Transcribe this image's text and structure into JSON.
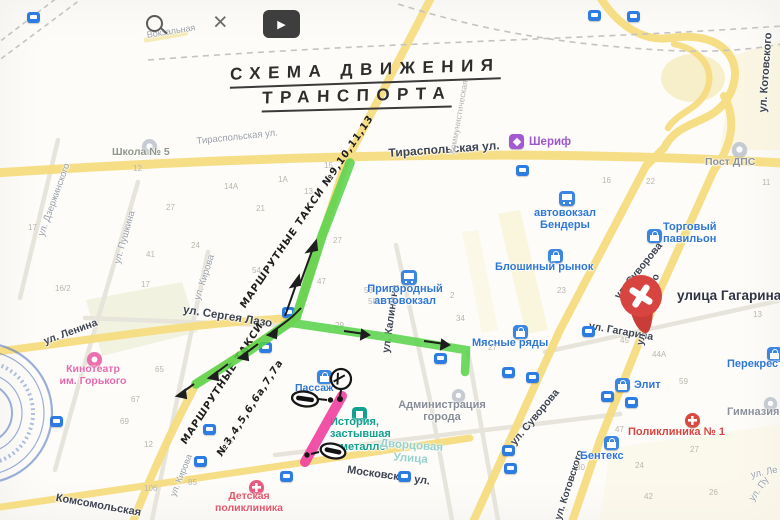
{
  "toolbar": {
    "close": "×",
    "play": "▶"
  },
  "title": {
    "line1": "СХЕМА ДВИЖЕНИЯ",
    "line2": "ТРАНСПОРТА"
  },
  "pin": {
    "label": "улица Гагарина"
  },
  "handwritten": [
    {
      "t": "МАРШРУТНЫЕ ТАКСИ №9,10,11,13",
      "x": 247,
      "y": 300,
      "r": -56,
      "s": 10
    },
    {
      "t": "МАРШРУТНЫЕ ТАКСИ",
      "x": 188,
      "y": 436,
      "r": -57,
      "s": 10
    },
    {
      "t": "№3,4,5,6,6а,7,7а",
      "x": 224,
      "y": 448,
      "r": -57,
      "s": 10
    }
  ],
  "colors": {
    "g": "#9aa0a8",
    "d": "#3e4450",
    "f": "#b8b5b0"
  },
  "streets": [
    {
      "t": "Вокзальная",
      "x": 146,
      "y": 30,
      "r": -9,
      "c": "g",
      "s": 9
    },
    {
      "t": "Тираспольская ул.",
      "x": 196,
      "y": 136,
      "r": -6,
      "c": "g",
      "s": 9.5
    },
    {
      "t": "Тираспольская ул.",
      "x": 388,
      "y": 146,
      "r": -4,
      "c": "d",
      "s": 12,
      "w": 700
    },
    {
      "t": "Коммунистическая",
      "x": 447,
      "y": 153,
      "r": -80,
      "c": "f",
      "s": 8.5
    },
    {
      "t": "ул. Дзержинского",
      "x": 36,
      "y": 234,
      "r": -70,
      "c": "g",
      "s": 9.5
    },
    {
      "t": "ул. Пушкина",
      "x": 112,
      "y": 262,
      "r": -74,
      "c": "g",
      "s": 9.5
    },
    {
      "t": "ул. Кирова",
      "x": 192,
      "y": 298,
      "r": -72,
      "c": "g",
      "s": 9.5
    },
    {
      "t": "ул. Кирова",
      "x": 168,
      "y": 494,
      "r": -68,
      "c": "g",
      "s": 9
    },
    {
      "t": "ул. Ленина",
      "x": 42,
      "y": 336,
      "r": -20,
      "c": "d",
      "s": 10.5,
      "w": 600
    },
    {
      "t": "ул. Сергея Лазо",
      "x": 184,
      "y": 304,
      "r": 9,
      "c": "d",
      "s": 11.5,
      "w": 600
    },
    {
      "t": "ул. Калинина",
      "x": 380,
      "y": 352,
      "r": -82,
      "c": "d",
      "s": 10.5,
      "w": 600
    },
    {
      "t": "Московская ул.",
      "x": 348,
      "y": 464,
      "r": 8,
      "c": "d",
      "s": 11,
      "w": 600
    },
    {
      "t": "Комсомольская",
      "x": 57,
      "y": 492,
      "r": 10,
      "c": "d",
      "s": 11,
      "w": 600
    },
    {
      "t": "ул. Суворова",
      "x": 612,
      "y": 294,
      "r": -51,
      "c": "d",
      "s": 10.5,
      "w": 600
    },
    {
      "t": "ул. Суворова",
      "x": 508,
      "y": 440,
      "r": -50,
      "c": "d",
      "s": 10.5,
      "w": 600
    },
    {
      "t": "ул. Гагарина",
      "x": 590,
      "y": 320,
      "r": 10,
      "c": "d",
      "s": 10.5,
      "w": 600
    },
    {
      "t": "ул. Котовского",
      "x": 757,
      "y": 112,
      "r": -86,
      "c": "d",
      "s": 11,
      "w": 600
    },
    {
      "t": "ул. Котовского",
      "x": 635,
      "y": 344,
      "r": -77,
      "c": "d",
      "s": 10,
      "w": 600
    },
    {
      "t": "ул. Котовского",
      "x": 553,
      "y": 518,
      "r": -72,
      "c": "d",
      "s": 10,
      "w": 600
    },
    {
      "t": "ул. Ле",
      "x": 750,
      "y": 470,
      "r": -12,
      "c": "g",
      "s": 9.5
    },
    {
      "t": "ул. Пу",
      "x": 747,
      "y": 497,
      "r": -55,
      "c": "g",
      "s": 9.5
    }
  ],
  "pois": [
    {
      "name": "school-5",
      "icon": "c-gray",
      "ix": 142,
      "iy": 139,
      "t": "Школа № 5",
      "x": 112,
      "y": 147,
      "c": "#8e978a",
      "s": 10.5,
      "w": 600
    },
    {
      "name": "sheriff",
      "icon": "sq-purple",
      "ix": 509,
      "iy": 134,
      "t": "Шериф",
      "x": 529,
      "y": 136,
      "c": "#9d54cd",
      "s": 11.5
    },
    {
      "name": "bus-station-bendery",
      "icon": "i-bus",
      "ix": 559,
      "iy": 191,
      "t": "автовокзал\nБендеры",
      "x": 525,
      "y": 207,
      "c": "#2f77d4",
      "s": 11,
      "wd": 80,
      "ta": "center"
    },
    {
      "name": "torgoviy-pavilion",
      "icon": "i-shop",
      "ix": 647,
      "iy": 229,
      "t": "Торговый\nпавильон",
      "x": 663,
      "y": 221,
      "c": "#2f77d4",
      "s": 11
    },
    {
      "name": "bloshiny-rynok",
      "icon": "i-shop",
      "ix": 548,
      "iy": 249,
      "t": "Блошиный рынок",
      "x": 495,
      "y": 261,
      "c": "#2f77d4",
      "s": 11
    },
    {
      "name": "prigorodny-avtovokzal",
      "icon": "i-bus",
      "ix": 401,
      "iy": 270,
      "t": "Пригородный\nавтовокзал",
      "x": 360,
      "y": 283,
      "c": "#2f77d4",
      "s": 11,
      "wd": 90,
      "ta": "center"
    },
    {
      "name": "myasnye-ryady",
      "icon": "i-shop",
      "ix": 513,
      "iy": 325,
      "t": "Мясные ряды",
      "x": 472,
      "y": 337,
      "c": "#2f77d4",
      "s": 11
    },
    {
      "name": "post-dps",
      "icon": "c-gray",
      "ix": 732,
      "iy": 142,
      "t": "Пост ДПС",
      "x": 705,
      "y": 157,
      "c": "#8b919b",
      "s": 10.5,
      "w": 600
    },
    {
      "name": "kinoteatr-gorkogo",
      "icon": "c-pink",
      "ix": 87,
      "iy": 352,
      "t": "Кинотеатр\nим. Горького",
      "x": 53,
      "y": 364,
      "c": "#e868ac",
      "s": 10.5,
      "wd": 80,
      "ta": "center"
    },
    {
      "name": "passazh",
      "icon": "i-shop",
      "ix": 317,
      "iy": 370,
      "t": "Пассаж",
      "x": 295,
      "y": 383,
      "c": "#2f77d4",
      "s": 10.5
    },
    {
      "name": "istoria-v-metalle",
      "icon": "sq-teal",
      "ix": 352,
      "iy": 407,
      "t": "История,\nзастывшая\nв металле",
      "x": 330,
      "y": 416,
      "c": "#12a08f",
      "s": 11
    },
    {
      "name": "administratsia-goroda",
      "icon": "c-gray-sm",
      "ix": 452,
      "iy": 389,
      "t": "Администрация\nгорода",
      "x": 392,
      "y": 399,
      "c": "#878d96",
      "s": 11,
      "w": 600,
      "wd": 100,
      "ta": "center"
    },
    {
      "name": "dvortsovaya-ulitsa",
      "icon": null,
      "t": "Дворцовая\nУлица",
      "x": 372,
      "y": 437,
      "c": "#96d2cb",
      "s": 11.5,
      "r": 4,
      "wd": 80,
      "ta": "center"
    },
    {
      "name": "detskaya-poliklinika",
      "icon": "cross-pink",
      "ix": 249,
      "iy": 480,
      "t": "Детская\nполиклиника",
      "x": 206,
      "y": 491,
      "c": "#e4566a",
      "s": 10.5,
      "wd": 86,
      "ta": "center"
    },
    {
      "name": "poliklinika-1",
      "icon": "cross-red",
      "ix": 685,
      "iy": 413,
      "t": "Поликлиника № 1",
      "x": 628,
      "y": 426,
      "c": "#d9453e",
      "s": 11
    },
    {
      "name": "benteks",
      "icon": "i-shop",
      "ix": 604,
      "iy": 436,
      "t": "Бентекс",
      "x": 580,
      "y": 450,
      "c": "#2f77d4",
      "s": 11
    },
    {
      "name": "elit",
      "icon": "i-shop",
      "ix": 615,
      "iy": 378,
      "t": "Элит",
      "x": 634,
      "y": 379,
      "c": "#2f77d4",
      "s": 11
    },
    {
      "name": "perekrestok",
      "icon": "i-shop",
      "ix": 767,
      "iy": 347,
      "t": "Перекресток",
      "x": 727,
      "y": 358,
      "c": "#2f77d4",
      "s": 11
    },
    {
      "name": "gimnazia",
      "icon": "c-gray-sm",
      "ix": 764,
      "iy": 397,
      "t": "Гимназия",
      "x": 727,
      "y": 406,
      "c": "#8b919b",
      "s": 11,
      "w": 600
    }
  ],
  "stops": [
    [
      27,
      12
    ],
    [
      588,
      10
    ],
    [
      627,
      11
    ],
    [
      516,
      165
    ],
    [
      282,
      307
    ],
    [
      259,
      342
    ],
    [
      434,
      353
    ],
    [
      582,
      326
    ],
    [
      203,
      424
    ],
    [
      194,
      456
    ],
    [
      280,
      471
    ],
    [
      398,
      471
    ],
    [
      50,
      416
    ],
    [
      601,
      391
    ],
    [
      625,
      397
    ],
    [
      502,
      367
    ],
    [
      526,
      372
    ],
    [
      502,
      445
    ],
    [
      504,
      463
    ]
  ],
  "numbers": [
    {
      "t": "12",
      "x": 133,
      "y": 164
    },
    {
      "t": "14А",
      "x": 224,
      "y": 182
    },
    {
      "t": "1А",
      "x": 278,
      "y": 175
    },
    {
      "t": "13",
      "x": 304,
      "y": 187
    },
    {
      "t": "15",
      "x": 324,
      "y": 161
    },
    {
      "t": "21",
      "x": 256,
      "y": 204
    },
    {
      "t": "17",
      "x": 28,
      "y": 223
    },
    {
      "t": "27",
      "x": 166,
      "y": 203
    },
    {
      "t": "24",
      "x": 191,
      "y": 241
    },
    {
      "t": "41",
      "x": 146,
      "y": 250
    },
    {
      "t": "17",
      "x": 141,
      "y": 280
    },
    {
      "t": "16/2",
      "x": 55,
      "y": 284
    },
    {
      "t": "54",
      "x": 252,
      "y": 266
    },
    {
      "t": "47",
      "x": 317,
      "y": 277
    },
    {
      "t": "27",
      "x": 333,
      "y": 236
    },
    {
      "t": "58",
      "x": 368,
      "y": 297
    },
    {
      "t": "29",
      "x": 335,
      "y": 321
    },
    {
      "t": "23",
      "x": 557,
      "y": 286
    },
    {
      "t": "34",
      "x": 456,
      "y": 314
    },
    {
      "t": "2",
      "x": 450,
      "y": 291
    },
    {
      "t": "27",
      "x": 488,
      "y": 343
    },
    {
      "t": "16",
      "x": 602,
      "y": 176
    },
    {
      "t": "22",
      "x": 646,
      "y": 177
    },
    {
      "t": "11",
      "x": 762,
      "y": 178
    },
    {
      "t": "13",
      "x": 753,
      "y": 310
    },
    {
      "t": "45",
      "x": 620,
      "y": 336
    },
    {
      "t": "44А",
      "x": 652,
      "y": 350
    },
    {
      "t": "59",
      "x": 679,
      "y": 377
    },
    {
      "t": "47",
      "x": 615,
      "y": 425
    },
    {
      "t": "27",
      "x": 690,
      "y": 445
    },
    {
      "t": "24",
      "x": 635,
      "y": 461
    },
    {
      "t": "42",
      "x": 644,
      "y": 492
    },
    {
      "t": "26",
      "x": 709,
      "y": 488
    },
    {
      "t": "30",
      "x": 576,
      "y": 463
    },
    {
      "t": "106",
      "x": 144,
      "y": 484
    },
    {
      "t": "85",
      "x": 188,
      "y": 478
    },
    {
      "t": "35",
      "x": 224,
      "y": 437
    },
    {
      "t": "12",
      "x": 144,
      "y": 440
    },
    {
      "t": "69",
      "x": 120,
      "y": 417
    },
    {
      "t": "67",
      "x": 131,
      "y": 395
    },
    {
      "t": "65",
      "x": 155,
      "y": 365
    },
    {
      "t": "53",
      "x": 364,
      "y": 286
    }
  ]
}
